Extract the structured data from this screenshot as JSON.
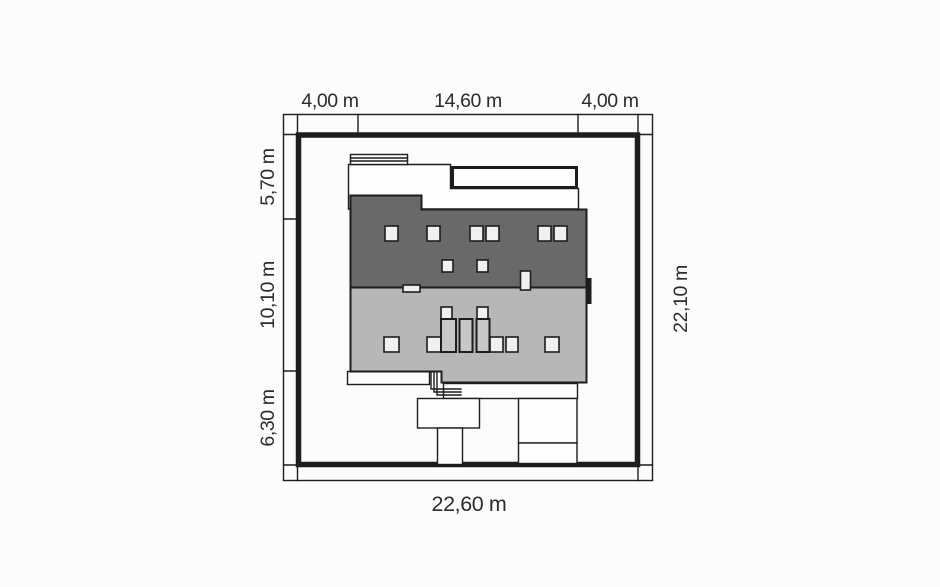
{
  "plan": {
    "name": "house-site-plan",
    "dimensions": {
      "top_left": "4,00 m",
      "top_middle": "14,60 m",
      "top_right": "4,00 m",
      "left_upper": "5,70 m",
      "left_middle": "10,10 m",
      "left_lower": "6,30 m",
      "right_full": "22,10 m",
      "bottom_full": "22,60 m"
    },
    "colors": {
      "background": "#fcfcfc",
      "line": "#1d1d1b",
      "roof_dark": "#696969",
      "roof_light": "#b7b7b7",
      "chimney": "#c7c7c7",
      "fixture": "#f0f0f0",
      "white_area": "#fdfdfd",
      "text": "#2b2b2b"
    }
  }
}
